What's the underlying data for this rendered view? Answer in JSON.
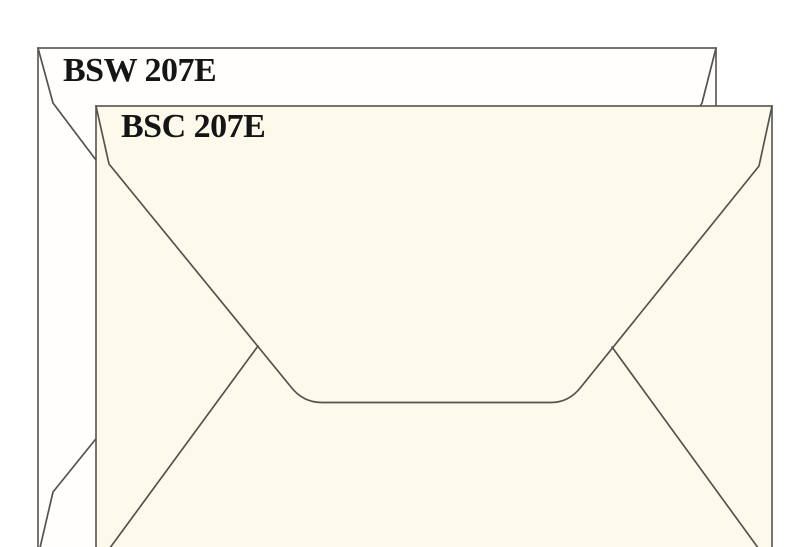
{
  "figure": {
    "background_color": "#ffffff",
    "outline_color": "#55534f",
    "label_color": "#151515"
  },
  "envelopes": {
    "back": {
      "label": "BSW 207E",
      "fill_color": "#fffefc"
    },
    "front": {
      "label": "BSC 207E",
      "fill_color": "#fdfaec"
    }
  }
}
